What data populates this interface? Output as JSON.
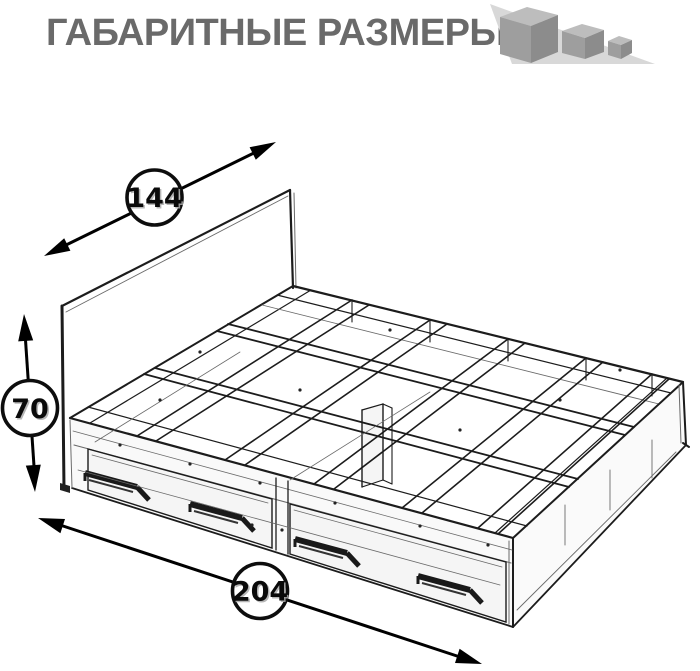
{
  "header": {
    "title": "ГАБАРИТНЫЕ РАЗМЕРЫ"
  },
  "logo": {
    "icon": "shrinking-cubes-icon",
    "cube_count": 3
  },
  "diagram": {
    "subject": "bed frame with two storage drawers, see-through wireframe projection",
    "dimensions": {
      "width": {
        "value": "144",
        "placement": "diagonal double arrow, upper left (headboard width)"
      },
      "height": {
        "value": "70",
        "placement": "vertical double arrow, left (bed height)"
      },
      "length": {
        "value": "204",
        "placement": "diagonal double arrow, bottom (bed length)"
      }
    }
  },
  "colors": {
    "title": "#6a6a6a",
    "line": "#1c1c1c",
    "logo_triangle": "#d8d8d8",
    "cube_top": "#bdbdbd",
    "cube_front": "#9e9e9e",
    "cube_side": "#8c8c8c",
    "background": "#ffffff"
  }
}
